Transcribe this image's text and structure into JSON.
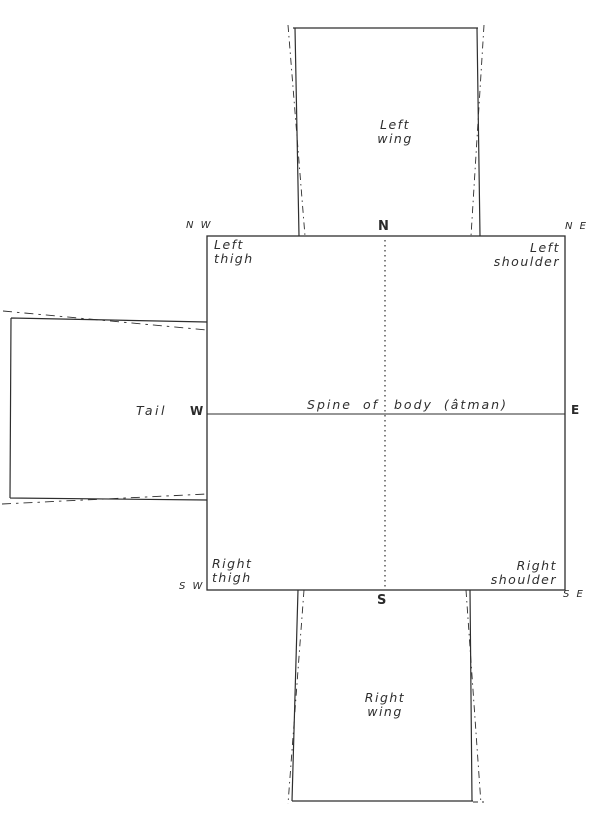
{
  "figure": {
    "background_color": "#ffffff",
    "ink_color": "#2e2e2e",
    "parts": {
      "left_wing": {
        "line1": "Left",
        "line2": "wing"
      },
      "right_wing": {
        "line1": "Right",
        "line2": "wing"
      },
      "tail": "Tail",
      "left_thigh": {
        "line1": "Left",
        "line2": "thigh"
      },
      "left_shoulder": {
        "line1": "Left",
        "line2": "shoulder"
      },
      "right_thigh": {
        "line1": "Right",
        "line2": "thigh"
      },
      "right_shoulder": {
        "line1": "Right",
        "line2": "shoulder"
      },
      "spine_left": "Spine of",
      "spine_right": "body (âtman)"
    },
    "compass": {
      "nw": "N W",
      "n": "N",
      "ne": "N E",
      "w": "W",
      "e": "E",
      "sw": "S W",
      "s": "S",
      "se": "S E"
    }
  }
}
